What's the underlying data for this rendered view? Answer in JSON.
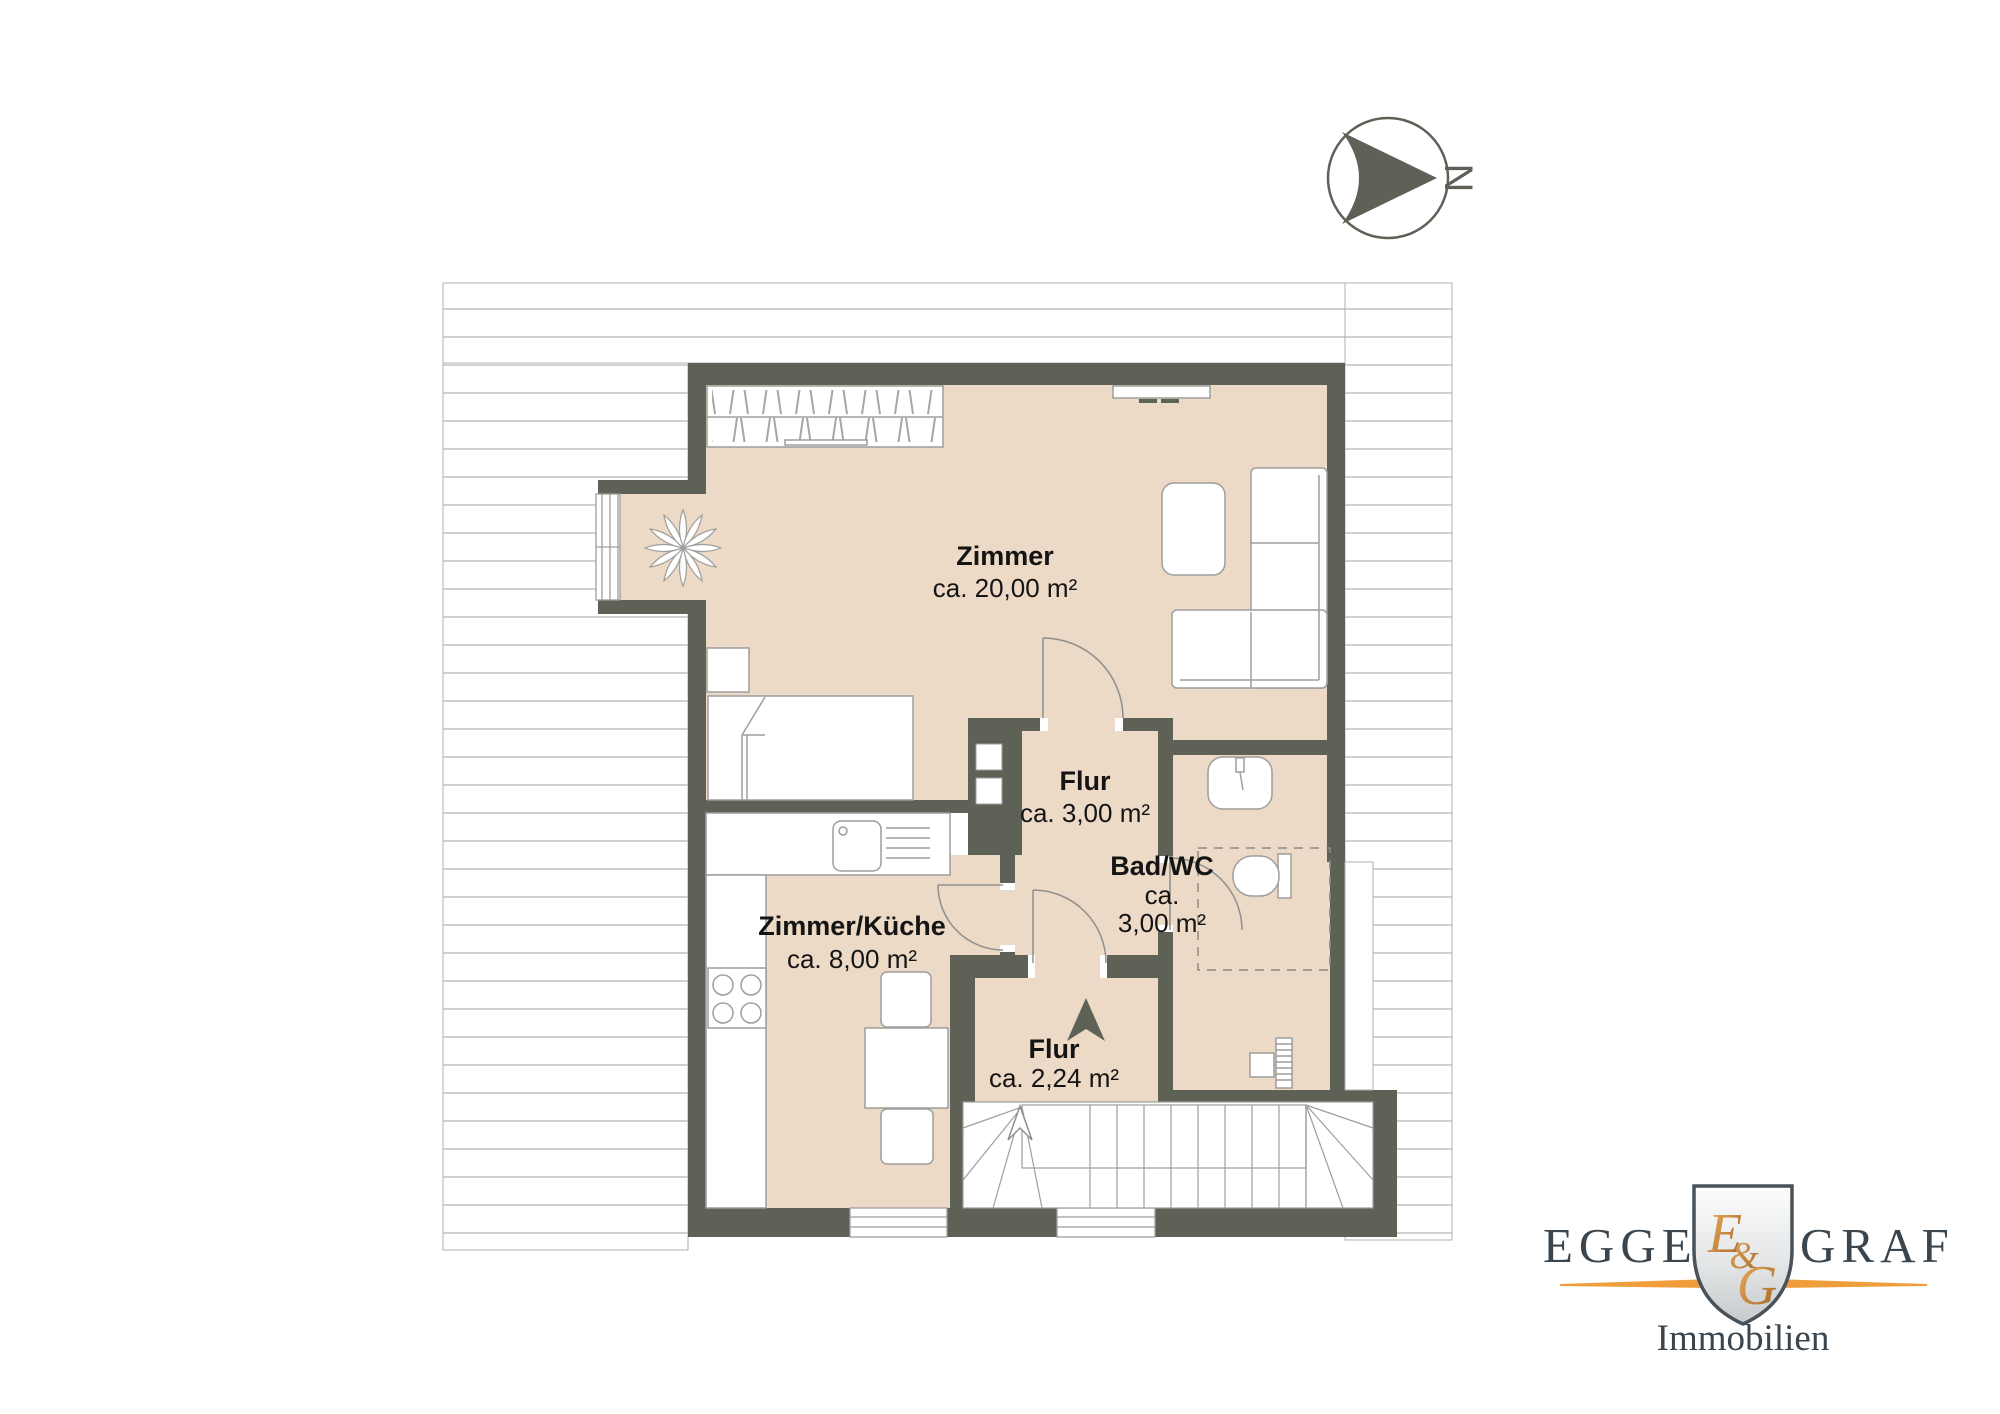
{
  "compass": {
    "north_label": "N"
  },
  "rooms": {
    "zimmer": {
      "name": "Zimmer",
      "area": "ca. 20,00 m²"
    },
    "flur": {
      "name": "Flur",
      "area": "ca. 3,00 m²"
    },
    "bad": {
      "name": "Bad/WC",
      "area_line1": "ca.",
      "area_line2": "3,00 m²"
    },
    "kueche": {
      "name": "Zimmer/Küche",
      "area": "ca. 8,00 m²"
    },
    "flur2": {
      "name": "Flur",
      "area": "ca. 2,24 m²"
    }
  },
  "logo": {
    "word_left": "EGGER",
    "word_right": "GRAF",
    "monogram_e": "E",
    "monogram_amp": "&",
    "monogram_g": "G",
    "subtitle": "Immobilien"
  },
  "colors": {
    "wall": "#5e6156",
    "floor": "#ecd9c6",
    "accent_orange": "#f09d3c",
    "logo_text": "#3a454d"
  }
}
